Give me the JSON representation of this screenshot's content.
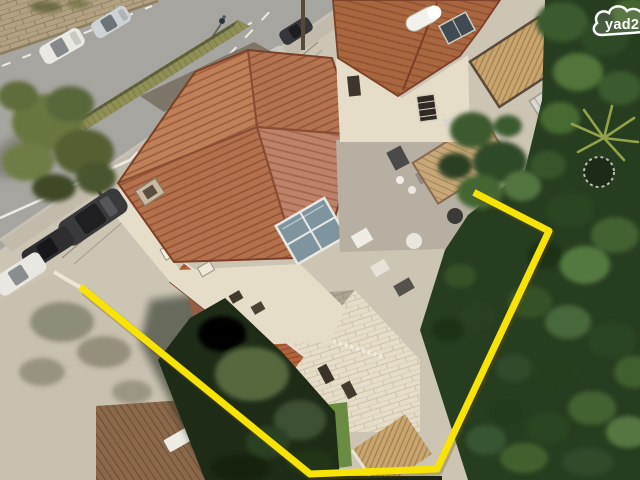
{
  "image": {
    "kind": "aerial-drone-photo",
    "alt": "Aerial view of a stone house with terracotta tiled roofs beside a street with parked cars, dense trees on the right, and a yellow property-lot outline drawn on the photo",
    "width": 640,
    "height": 480
  },
  "watermark": {
    "text": "yad2"
  },
  "annotation": {
    "meaning": "property-lot-boundary-outline",
    "boundary_points": [
      [
        83,
        289
      ],
      [
        310,
        474
      ],
      [
        437,
        469
      ],
      [
        549,
        231
      ],
      [
        477,
        194
      ]
    ]
  },
  "colors": {
    "road": "#a7a5a0",
    "roadline": "#eceae3",
    "concrete": "#cdc5b4",
    "wallcream": "#e6ddc8",
    "stonewall": "#b3a183",
    "roof": "#b5714b",
    "treedark": "#273d20",
    "hedge": "#8f9055",
    "deckwood": "#8a6849",
    "pergolatan": "#c9a56e",
    "boundary": "#f8e306",
    "logowhite": "#ffffff"
  }
}
